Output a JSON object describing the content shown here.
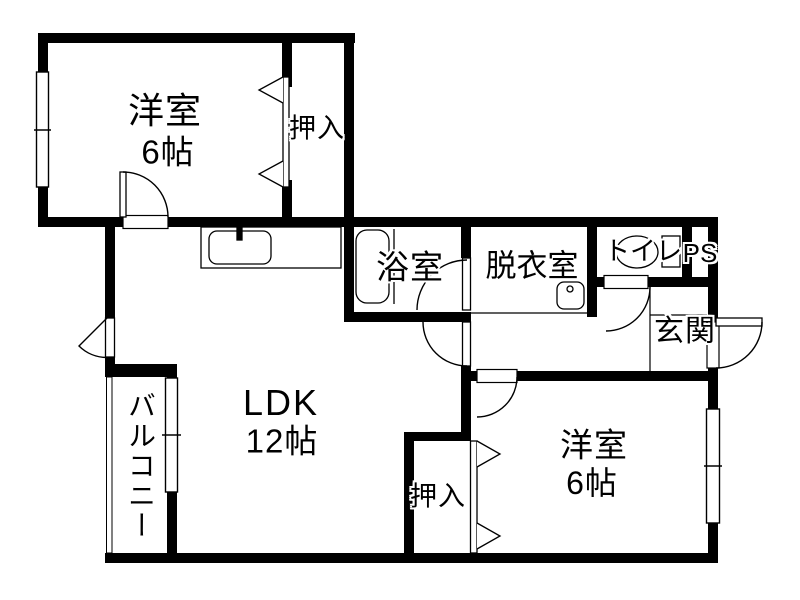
{
  "floorplan": {
    "type": "apartment-floor-plan",
    "colors": {
      "wall": "#000000",
      "background": "#ffffff",
      "line": "#000000"
    },
    "rooms": {
      "bedroom1": {
        "name": "洋室",
        "size": "6帖"
      },
      "closet1": {
        "name": "押入"
      },
      "bath": {
        "name": "浴室"
      },
      "washroom": {
        "name": "脱衣室"
      },
      "toilet": {
        "name": "トイレ"
      },
      "ps": {
        "name": "PS"
      },
      "entrance": {
        "name": "玄関"
      },
      "ldk": {
        "name": "LDK",
        "size": "12帖"
      },
      "balcony": {
        "name": "バルコニー"
      },
      "closet2": {
        "name": "押入"
      },
      "bedroom2": {
        "name": "洋室",
        "size": "6帖"
      }
    }
  }
}
